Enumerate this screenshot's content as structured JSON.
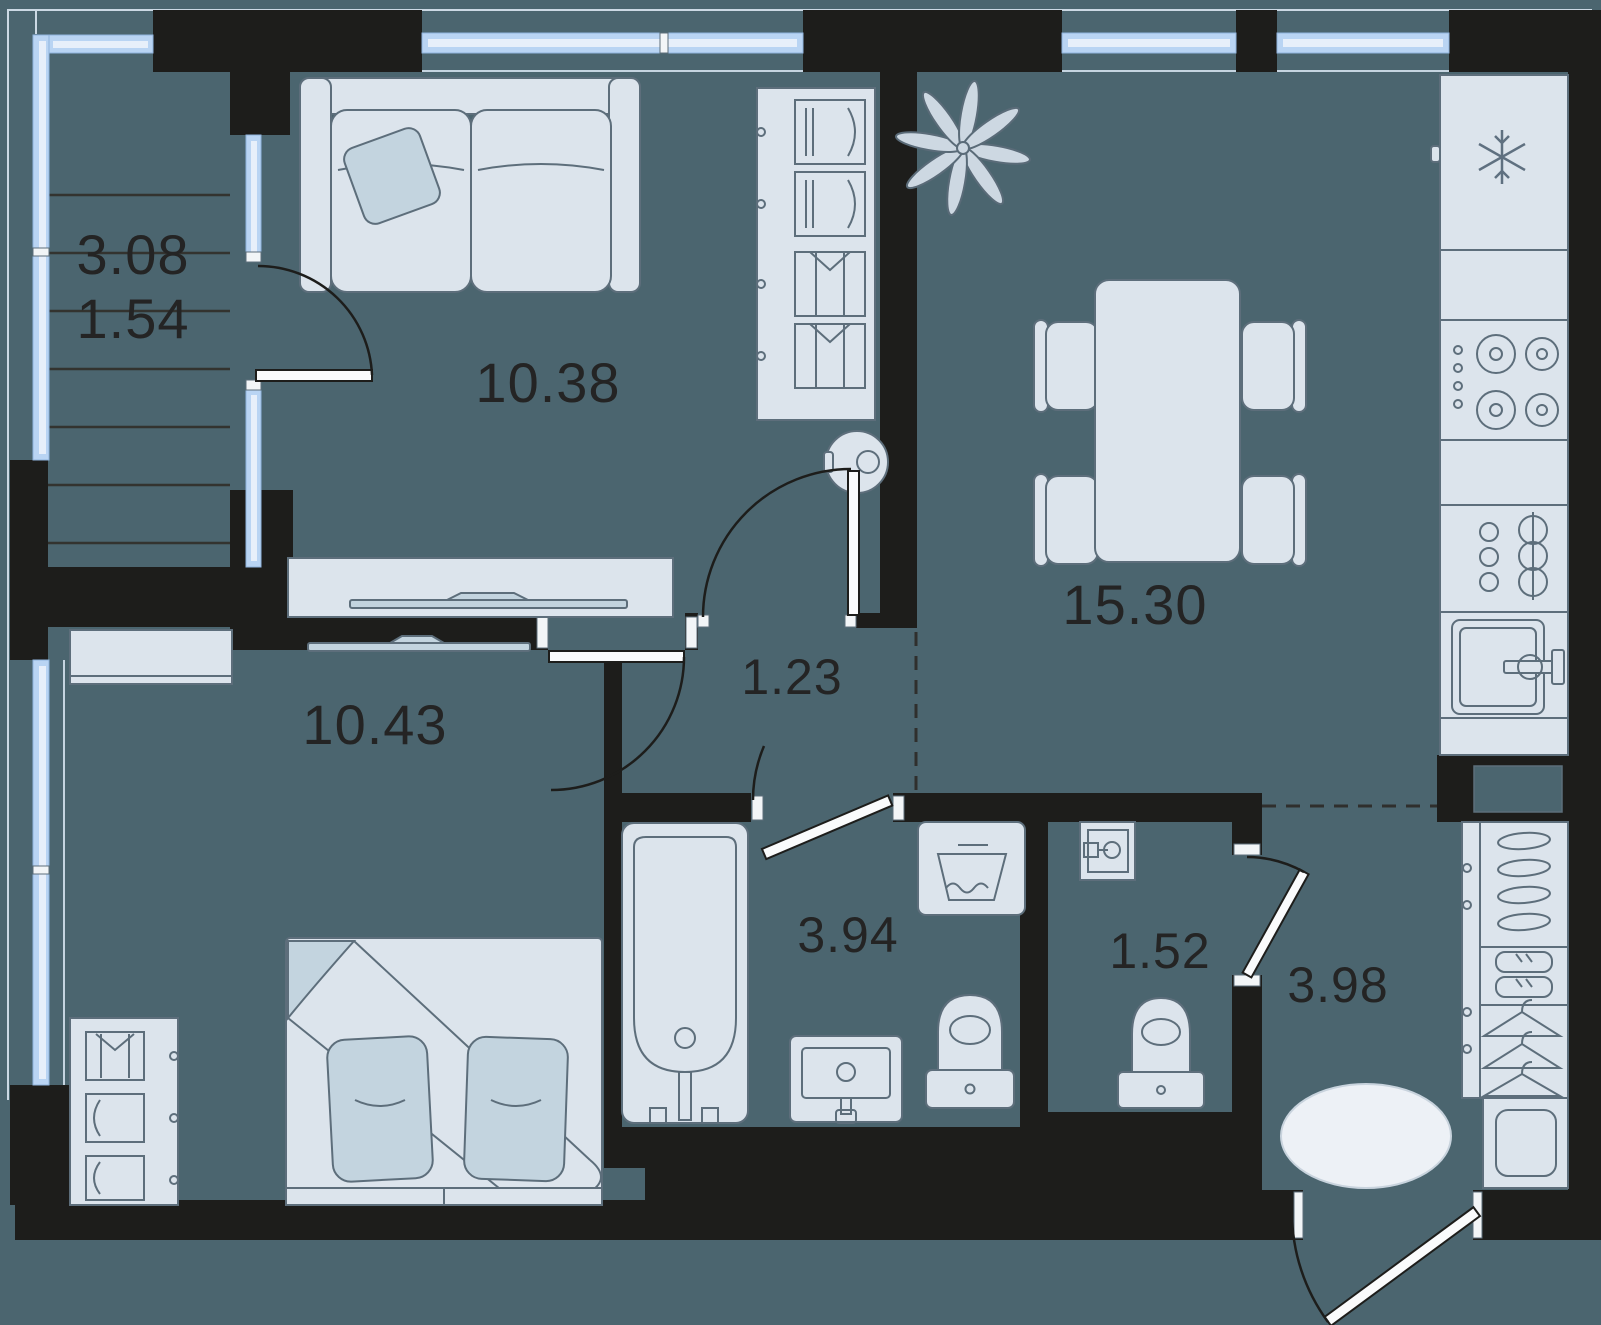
{
  "plan": {
    "type": "apartment-floor-plan",
    "colors": {
      "floor": "#4b656f",
      "wall": "#1d1d1b",
      "furniture": "#dce4ec",
      "furniture_stroke": "#5d6e7b",
      "soft_accent": "#c3d4df",
      "window": "#b9d4f3",
      "label": "#242424"
    }
  },
  "rooms": [
    {
      "id": "balcony",
      "area": "3.08",
      "area_reduced": "1.54"
    },
    {
      "id": "living-room",
      "area": "10.38"
    },
    {
      "id": "kitchen-living-room",
      "area": "15.30"
    },
    {
      "id": "bedroom",
      "area": "10.43"
    },
    {
      "id": "hallway",
      "area": "1.23"
    },
    {
      "id": "bathroom",
      "area": "3.94"
    },
    {
      "id": "wc",
      "area": "1.52"
    },
    {
      "id": "entrance-hall",
      "area": "3.98"
    }
  ]
}
